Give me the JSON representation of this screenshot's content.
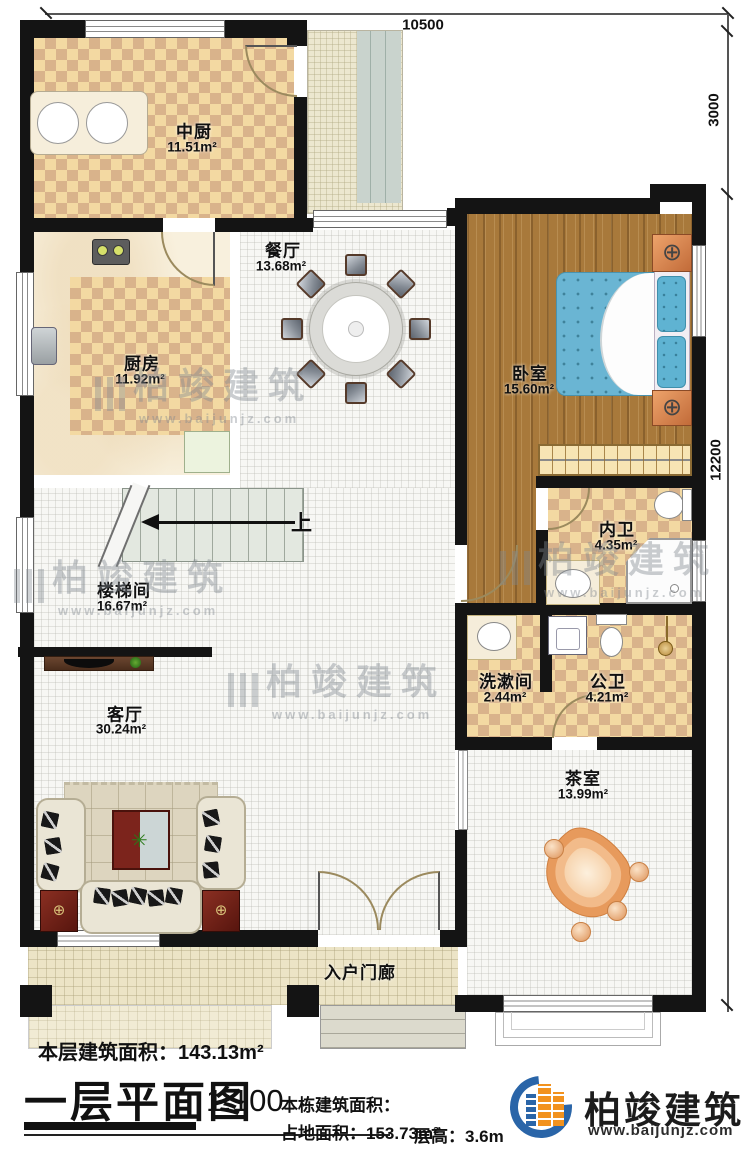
{
  "plan": {
    "type": "architectural-floor-plan",
    "floor": "一层",
    "rooms": {
      "zhongchu": {
        "name": "中厨",
        "area": "11.51m²"
      },
      "dining": {
        "name": "餐厅",
        "area": "13.68m²"
      },
      "kitchen": {
        "name": "厨房",
        "area": "11.92m²"
      },
      "bedroom": {
        "name": "卧室",
        "area": "15.60m²"
      },
      "ensuite": {
        "name": "内卫",
        "area": "4.35m²"
      },
      "stairwell": {
        "name": "楼梯间",
        "area": "16.67m²"
      },
      "washroom": {
        "name": "洗漱间",
        "area": "2.44m²"
      },
      "public_bath": {
        "name": "公卫",
        "area": "4.21m²"
      },
      "living": {
        "name": "客厅",
        "area": "30.24m²"
      },
      "tea_room": {
        "name": "茶室",
        "area": "13.99m²"
      },
      "porch": {
        "name": "入户门廊"
      }
    },
    "labels": {
      "up": "上"
    },
    "dimensions": {
      "top": "10500",
      "right_upper": "3000",
      "right_lower": "12200"
    }
  },
  "footer": {
    "floor_area": "本层建筑面积：143.13m²",
    "title": "一层平面图",
    "scale": "1:100",
    "building_area_label": "本栋建筑面积：",
    "land_area": "占地面积：153.73m²",
    "floor_height": "层高：3.6m"
  },
  "brand": {
    "name": "柏竣建筑",
    "url": "www.baijunjz.com"
  },
  "watermark": {
    "text": "柏竣建筑",
    "url": "www.baijunjz.com"
  },
  "colors": {
    "wall": "#141414",
    "checker_light": "#f3d9a2",
    "checker_dark": "#d9b38b",
    "wood": "#a8793b",
    "bed_blue": "#6ab5d3",
    "brand_blue": "#2a65a8",
    "brand_orange": "#f2921e"
  }
}
